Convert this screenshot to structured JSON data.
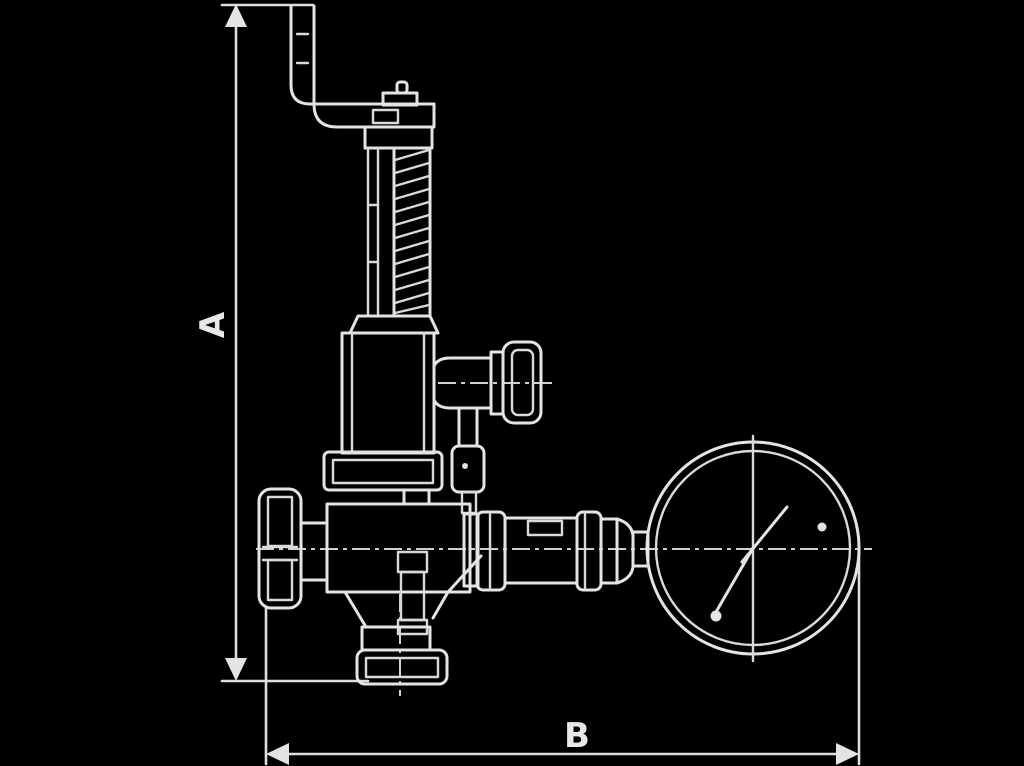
{
  "figure": {
    "type": "technical-dimensional-drawing",
    "subject": "overflow-relief-valve-with-pressure-gauge",
    "background_color": "#000000",
    "line_color": "#e4e4e4"
  },
  "dimensions": {
    "height_label": "A",
    "length_label": "B"
  }
}
